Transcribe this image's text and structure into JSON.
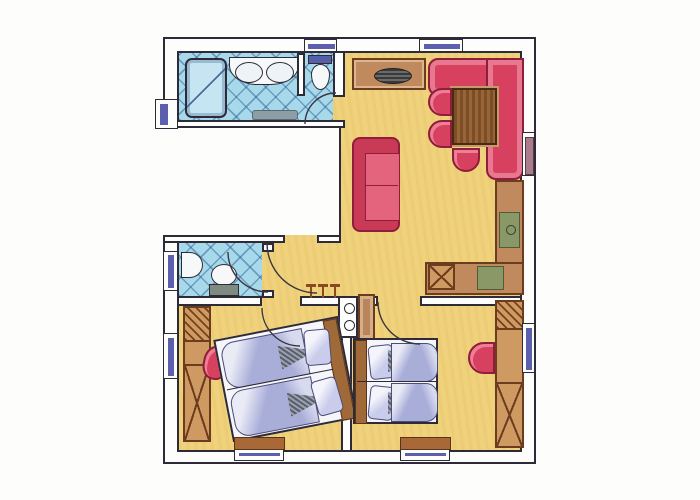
{
  "plan": {
    "type": "apartment-floor-plan",
    "style": "hand-drawn colored pencil",
    "palette": {
      "floor_yellow": "#f0d27d",
      "tile_blue": "#a7d9ea",
      "upholstery_red": "#d84060",
      "wood_brown": "#c08a5e",
      "bedding_lavender": "#a9aed9",
      "appliance_green": "#8a9767",
      "window_blue": "#5b5fae",
      "wall_line": "#2e2b38"
    },
    "rooms": [
      {
        "name": "Bathroom",
        "floor": "blue tiles"
      },
      {
        "name": "Toilet nook",
        "floor": "blue tiles"
      },
      {
        "name": "Living / dining room",
        "floor": "yellow"
      },
      {
        "name": "Kitchenette",
        "floor": "yellow"
      },
      {
        "name": "Hallway",
        "floor": "yellow"
      },
      {
        "name": "Separate WC",
        "floor": "blue tiles"
      },
      {
        "name": "Bedroom 1",
        "floor": "yellow"
      },
      {
        "name": "Bedroom 2",
        "floor": "yellow"
      },
      {
        "name": "Stairwell recess",
        "floor": "none (outside unit)"
      }
    ],
    "furniture": {
      "bathroom": [
        "bathtub",
        "double-basin vanity",
        "bath mat",
        "toilet with cistern"
      ],
      "wc": [
        "wash basin",
        "toilet with cistern"
      ],
      "living_dining": [
        "sideboard with dish",
        "L-shaped corner bench",
        "dining table",
        "3 round chairs",
        "two-seat sofa"
      ],
      "kitchenette": [
        "L-shaped counter",
        "sink",
        "stove",
        "appliance / duct square"
      ],
      "hallway": [
        "coat hooks (3)",
        "service duct with two circles",
        "small cabinet"
      ],
      "bedroom_1": [
        "wardrobe",
        "double bed (rotated)",
        "red pouf"
      ],
      "bedroom_2": [
        "double bed",
        "wardrobe",
        "red chair"
      ]
    },
    "openings": {
      "windows": [
        "top wall x2",
        "left wall x3",
        "right wall x2",
        "bottom wall x2"
      ],
      "doors": [
        "entrance from stair recess",
        "bathroom",
        "wc",
        "bedroom 1",
        "bedroom 2"
      ]
    }
  }
}
